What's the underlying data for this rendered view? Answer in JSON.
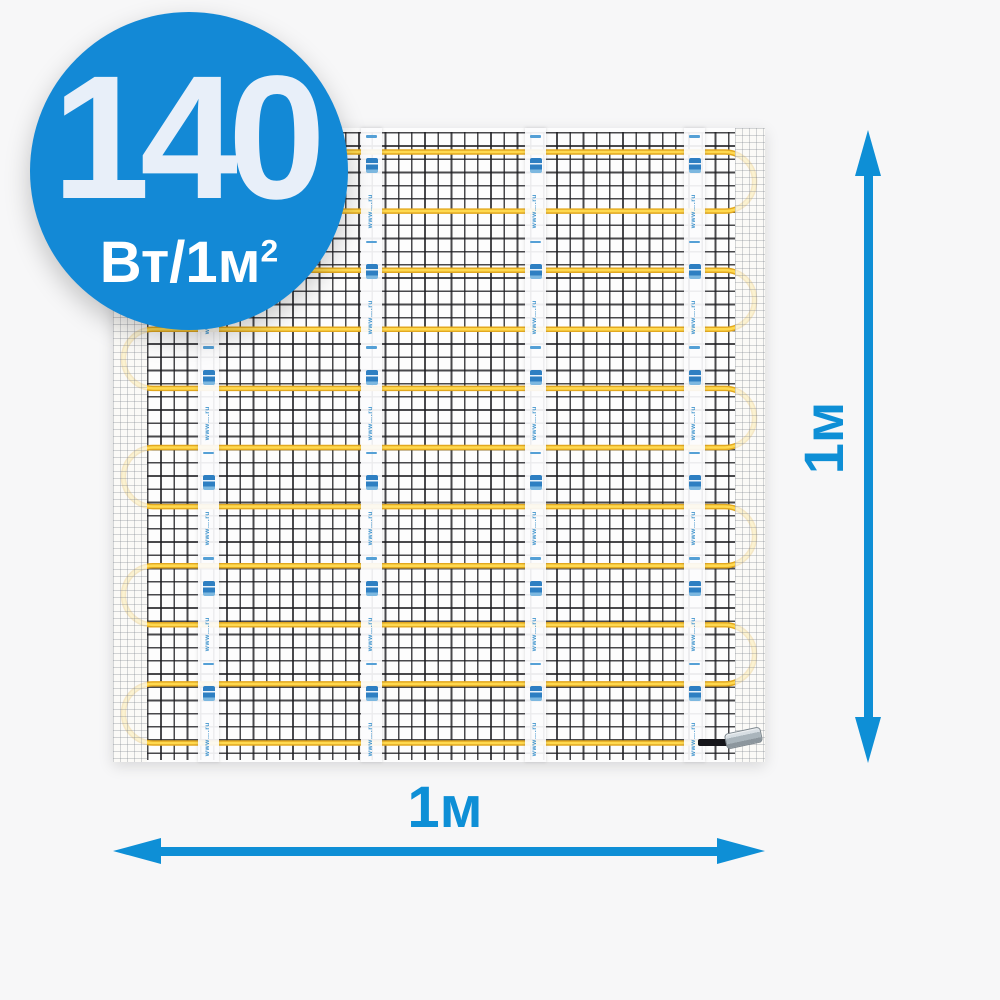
{
  "background_color": "#F7F7F8",
  "accent_color": "#0E8FD6",
  "badge": {
    "value": "140",
    "unit": "Вт/1м",
    "unit_exponent": "2",
    "bg_color": "#1389D6",
    "value_color": "#E8EFF9",
    "unit_color": "#FFFFFF"
  },
  "mat": {
    "rows": 11,
    "tape_count": 4,
    "tape_units_per_strip": 6,
    "tape_text": "www….ru",
    "cable_color": "#E2A81F",
    "cable_core_color": "#FFD94F",
    "mesh_line_color": "#1C1C20",
    "stamp_color": "#2E7FC2",
    "connector": "cable-end-sleeve"
  },
  "dimensions": {
    "width": {
      "label": "1м"
    },
    "height": {
      "label": "1м"
    }
  }
}
